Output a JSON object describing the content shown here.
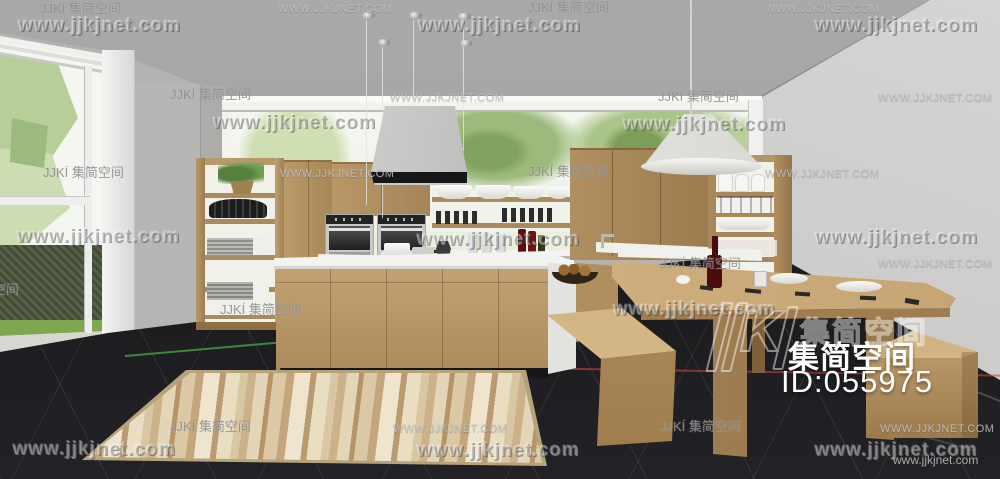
{
  "image": {
    "width": 1000,
    "height": 479,
    "description": "3D interior rendering of a modern light-wood kitchen with open shelving, two built-in ovens, island with range hood, long dining table with benches, striped rug on dark tile floor, and garden views through window and glass door"
  },
  "watermark": {
    "bold_text": "www.jjkjnet.com",
    "caps_text": "WWW.JJKJNET.COM",
    "brand_text": "JJKÍ 集简空间",
    "small_text": "www.jjkjnet.com",
    "bold_positions": [
      [
        18,
        16
      ],
      [
        418,
        16
      ],
      [
        815,
        16
      ],
      [
        213,
        113
      ],
      [
        623,
        115
      ],
      [
        17,
        227
      ],
      [
        417,
        230
      ],
      [
        815,
        228
      ],
      [
        613,
        300
      ],
      [
        13,
        440
      ],
      [
        417,
        441
      ],
      [
        815,
        441
      ]
    ],
    "caps_positions": [
      [
        278,
        3
      ],
      [
        765,
        3
      ],
      [
        390,
        92
      ],
      [
        878,
        92
      ],
      [
        280,
        168
      ],
      [
        765,
        168
      ],
      [
        878,
        258
      ],
      [
        393,
        423
      ],
      [
        880,
        423
      ]
    ],
    "brand_positions": [
      [
        40,
        2
      ],
      [
        528,
        1
      ],
      [
        170,
        88
      ],
      [
        658,
        90
      ],
      [
        43,
        166
      ],
      [
        528,
        165
      ],
      [
        660,
        257
      ],
      [
        220,
        303
      ],
      [
        -62,
        283
      ],
      [
        170,
        420
      ],
      [
        660,
        420
      ]
    ],
    "small_positions": [
      [
        893,
        454
      ]
    ]
  },
  "badge": {
    "logo_k": "K",
    "ghost_text": "集简空间",
    "brand_text": "集简空间",
    "id_text": "ID:055975"
  },
  "palette": {
    "ceiling": "#a4a4a2",
    "right_wall": "#cdcdcb",
    "back_wall": "#b3b3b1",
    "floor": "#1e1e21",
    "wood_cabinet": "#b29160",
    "wood_table_top": "#d6b886",
    "counter_white": "#f2f2ee",
    "hood_steel": "#c7c7c5",
    "greenery": "#8fae6b",
    "hedge": "#4f5b41",
    "grass": "#7ea750",
    "rug_base": "#dcc9a5",
    "wine_bottle": "#4a0d0d",
    "watermark_white": "#f0f0f0"
  }
}
